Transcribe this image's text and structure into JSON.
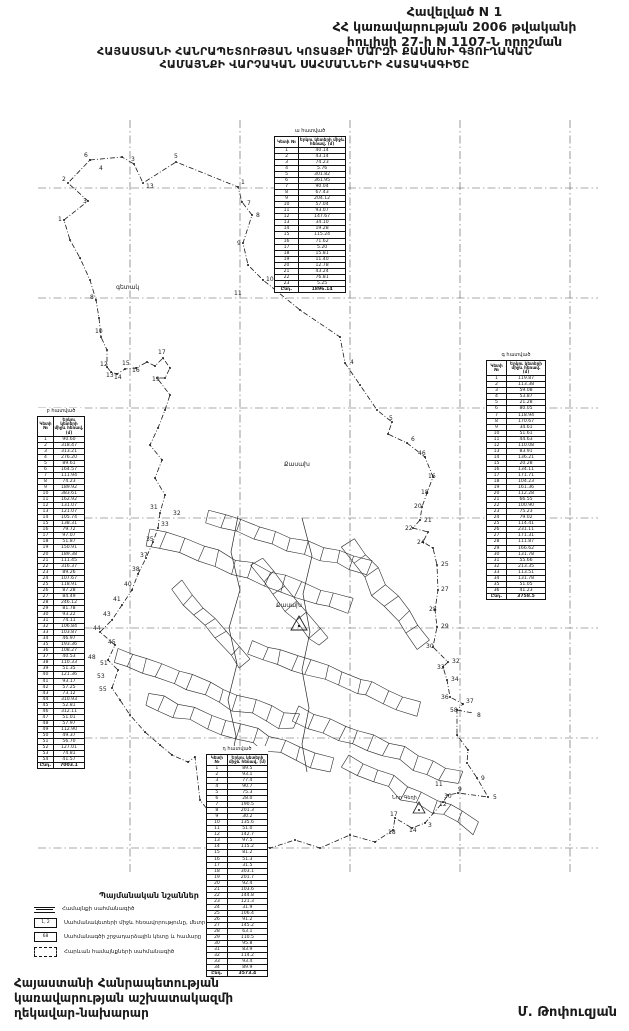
{
  "header": {
    "line1": "Հավելված N 1",
    "line2": "ՀՀ կառավարության 2006 թվականի",
    "line3": "հուլիսի 27-ի N 1107-Ն որոշման"
  },
  "title": {
    "line1": "ՀԱՅԱՍՏԱՆԻ ՀԱՆՐԱՊԵՏՈՒԹՅԱՆ ԿՈՏԱՅՔԻ ՄԱՐԶԻ ՔԱՍԱԽԻ ԳՅՈՒՂԱԿԱՆ",
    "line2": "ՀԱՄԱՅՆՔԻ ՎԱՐՉԱԿԱՆ ՍԱՀՄԱՆՆԵՐԻ ՀԱՏԱԿԱԳԻԾԸ"
  },
  "tables": {
    "top": {
      "caption": "ա հատված",
      "col_point": "Կետի №",
      "col_dist": "Երկու կետերի միջև հեռավ. (մ)",
      "rows": [
        [
          "1",
          "40.14"
        ],
        [
          "2",
          "43.14"
        ],
        [
          "3",
          "74.23"
        ],
        [
          "4",
          "5.76"
        ],
        [
          "5",
          "301.82"
        ],
        [
          "6",
          "361.95"
        ],
        [
          "7",
          "90.04"
        ],
        [
          "8",
          "67.43"
        ],
        [
          "9",
          "204.12"
        ],
        [
          "10",
          "57.04"
        ],
        [
          "11",
          "93.07"
        ],
        [
          "12",
          "147.67"
        ],
        [
          "13",
          "34.10"
        ],
        [
          "14",
          "19.28"
        ],
        [
          "15",
          "115.24"
        ],
        [
          "16",
          "71.62"
        ],
        [
          "17",
          "5.20"
        ],
        [
          "18",
          "15.81"
        ],
        [
          "19",
          "11.40"
        ],
        [
          "20",
          "12.78"
        ],
        [
          "21",
          "43.24"
        ],
        [
          "22",
          "76.81"
        ],
        [
          "23",
          "5.25"
        ]
      ],
      "total_label": "Ընդ.",
      "total_value": "1896.14"
    },
    "left": {
      "caption": "բ հատված",
      "col_point": "Կետի №",
      "col_dist": "Երկու կետերի միջև հեռավ. (մ)",
      "rows": [
        [
          "1",
          "90.60"
        ],
        [
          "2",
          "318.47"
        ],
        [
          "3",
          "313.21"
        ],
        [
          "4",
          "276.20"
        ],
        [
          "5",
          "89.61"
        ],
        [
          "6",
          "164.57"
        ],
        [
          "7",
          "111.94"
        ],
        [
          "8",
          "74.23"
        ],
        [
          "9",
          "189.92"
        ],
        [
          "10",
          "383.61"
        ],
        [
          "11",
          "162.92"
        ],
        [
          "12",
          "131.07"
        ],
        [
          "13",
          "121.07"
        ],
        [
          "14",
          "105.74"
        ],
        [
          "15",
          "138.31"
        ],
        [
          "16",
          "79.72"
        ],
        [
          "17",
          "97.07"
        ],
        [
          "18",
          "51.87"
        ],
        [
          "19",
          "150.91"
        ],
        [
          "20",
          "189.38"
        ],
        [
          "21",
          "111.45"
        ],
        [
          "22",
          "316.37"
        ],
        [
          "23",
          "89.26"
        ],
        [
          "24",
          "107.67"
        ],
        [
          "25",
          "118.91"
        ],
        [
          "26",
          "87.28"
        ],
        [
          "27",
          "84.49"
        ],
        [
          "28",
          "246.12"
        ],
        [
          "29",
          "81.78"
        ],
        [
          "30",
          "93.22"
        ],
        [
          "31",
          "74.11"
        ],
        [
          "32",
          "106.84"
        ],
        [
          "33",
          "103.87"
        ],
        [
          "34",
          "46.97"
        ],
        [
          "35",
          "193.36"
        ],
        [
          "36",
          "108.27"
        ],
        [
          "37",
          "40.53"
        ],
        [
          "38",
          "110.33"
        ],
        [
          "39",
          "51.35"
        ],
        [
          "40",
          "121.36"
        ],
        [
          "41",
          "93.17"
        ],
        [
          "42",
          "57.25"
        ],
        [
          "43",
          "73.12"
        ],
        [
          "44",
          "310.93"
        ],
        [
          "45",
          "52.81"
        ],
        [
          "46",
          "312.11"
        ],
        [
          "47",
          "51.01"
        ],
        [
          "48",
          "57.97"
        ],
        [
          "49",
          "112.90"
        ],
        [
          "50",
          "49.37"
        ],
        [
          "51",
          "56.70"
        ],
        [
          "52",
          "127.01"
        ],
        [
          "53",
          "74.81"
        ],
        [
          "54",
          "41.57"
        ]
      ],
      "total_label": "Ընդ.",
      "total_value": "7003.1"
    },
    "right": {
      "caption": "գ հատված",
      "col_point": "Կետի №",
      "col_dist": "Երկու կետերի միջև հեռավ. (մ)",
      "rows": [
        [
          "1",
          "119.87"
        ],
        [
          "2",
          "113.38"
        ],
        [
          "3",
          "59.08"
        ],
        [
          "4",
          "53.87"
        ],
        [
          "5",
          "21.28"
        ],
        [
          "6",
          "80.05"
        ],
        [
          "7",
          "118.94"
        ],
        [
          "8",
          "170.67"
        ],
        [
          "9",
          "34.61"
        ],
        [
          "10",
          "51.61"
        ],
        [
          "11",
          "44.63"
        ],
        [
          "12",
          "110.08"
        ],
        [
          "13",
          "83.91"
        ],
        [
          "14",
          "136.21"
        ],
        [
          "15",
          "20.28"
        ],
        [
          "16",
          "134.11"
        ],
        [
          "17",
          "171.71"
        ],
        [
          "18",
          "104.23"
        ],
        [
          "19",
          "161.36"
        ],
        [
          "20",
          "112.28"
        ],
        [
          "21",
          "66.55"
        ],
        [
          "22",
          "100.90"
        ],
        [
          "23",
          "75.23"
        ],
        [
          "24",
          "79.02"
        ],
        [
          "25",
          "114.41"
        ],
        [
          "26",
          "231.11"
        ],
        [
          "27",
          "171.31"
        ],
        [
          "28",
          "111.87"
        ],
        [
          "29",
          "166.62"
        ],
        [
          "30",
          "131.78"
        ],
        [
          "31",
          "55.66"
        ],
        [
          "32",
          "213.35"
        ],
        [
          "33",
          "113.51"
        ],
        [
          "34",
          "131.78"
        ],
        [
          "35",
          "51.05"
        ],
        [
          "36",
          "41.23"
        ]
      ],
      "total_label": "Ընդ.",
      "total_value": "3758.5"
    },
    "bottom": {
      "caption": "դ հատված",
      "col_point": "Կետի №",
      "col_dist": "Երկու կետերի միջև հեռավ. (մ)",
      "rows": [
        [
          "1",
          "89.5"
        ],
        [
          "2",
          "93.1"
        ],
        [
          "3",
          "77.4"
        ],
        [
          "4",
          "90.7"
        ],
        [
          "5",
          "75.3"
        ],
        [
          "6",
          "28.0"
        ],
        [
          "7",
          "190.5"
        ],
        [
          "8",
          "201.3"
        ],
        [
          "9",
          "30.2"
        ],
        [
          "10",
          "135.6"
        ],
        [
          "11",
          "51.0"
        ],
        [
          "12",
          "142.7"
        ],
        [
          "13",
          "97.5"
        ],
        [
          "14",
          "115.2"
        ],
        [
          "15",
          "81.2"
        ],
        [
          "16",
          "51.3"
        ],
        [
          "17",
          "31.5"
        ],
        [
          "18",
          "303.1"
        ],
        [
          "19",
          "201.7"
        ],
        [
          "20",
          "92.4"
        ],
        [
          "21",
          "103.6"
        ],
        [
          "22",
          "144.8"
        ],
        [
          "23",
          "121.3"
        ],
        [
          "24",
          "31.9"
        ],
        [
          "25",
          "106.4"
        ],
        [
          "26",
          "91.2"
        ],
        [
          "27",
          "145.2"
        ],
        [
          "28",
          "63.1"
        ],
        [
          "29",
          "110.5"
        ],
        [
          "30",
          "95.8"
        ],
        [
          "31",
          "83.9"
        ],
        [
          "32",
          "114.2"
        ],
        [
          "33",
          "93.4"
        ],
        [
          "34",
          "89.9"
        ]
      ],
      "total_label": "Ընդ.",
      "total_value": "3573.4"
    }
  },
  "legend": {
    "title": "Պայմանական նշաններ",
    "symbol2_text": "1, 2",
    "symbol3_text": "68",
    "items": [
      {
        "label": "Համայնքի սահմանագիծ"
      },
      {
        "label": "Սահմանակետերի միջև հեռավորությունը, մետր"
      },
      {
        "label": "Սահմանագծի շրջադարձային կետը և համարը"
      },
      {
        "label": "Հարևան համայնքների սահմանագիծ"
      }
    ]
  },
  "footer": {
    "left_line1": "Հայաստանի Հանրապետության",
    "left_line2": "կառավարության աշխատակազմի",
    "left_line3": "ղեկավար-նախարար",
    "signature": "Մ. Թոփուզյան"
  },
  "map": {
    "place_labels": [
      {
        "t": "գետակ",
        "x": 116,
        "y": 289,
        "s": 6
      },
      {
        "t": "Քասախ",
        "x": 284,
        "y": 466,
        "s": 6
      },
      {
        "t": "Քասախ",
        "x": 276,
        "y": 607,
        "s": 6
      },
      {
        "t": "Նոր Գեղի",
        "x": 392,
        "y": 799,
        "s": 5
      }
    ],
    "point_labels": [
      {
        "t": "6",
        "x": 84,
        "y": 157
      },
      {
        "t": "4",
        "x": 99,
        "y": 170
      },
      {
        "t": "3",
        "x": 131,
        "y": 161
      },
      {
        "t": "13",
        "x": 146,
        "y": 188
      },
      {
        "t": "5",
        "x": 174,
        "y": 158
      },
      {
        "t": "1",
        "x": 241,
        "y": 184
      },
      {
        "t": "7",
        "x": 247,
        "y": 205
      },
      {
        "t": "8",
        "x": 256,
        "y": 217
      },
      {
        "t": "9",
        "x": 237,
        "y": 245
      },
      {
        "t": "10",
        "x": 266,
        "y": 281
      },
      {
        "t": "11",
        "x": 234,
        "y": 295
      },
      {
        "t": "2",
        "x": 62,
        "y": 181
      },
      {
        "t": "3",
        "x": 83,
        "y": 203
      },
      {
        "t": "1",
        "x": 58,
        "y": 221
      },
      {
        "t": "8",
        "x": 90,
        "y": 299
      },
      {
        "t": "10",
        "x": 95,
        "y": 333
      },
      {
        "t": "12",
        "x": 100,
        "y": 366
      },
      {
        "t": "13",
        "x": 106,
        "y": 377
      },
      {
        "t": "14",
        "x": 114,
        "y": 379
      },
      {
        "t": "15",
        "x": 122,
        "y": 365
      },
      {
        "t": "16",
        "x": 132,
        "y": 372
      },
      {
        "t": "17",
        "x": 158,
        "y": 354
      },
      {
        "t": "19",
        "x": 152,
        "y": 381
      },
      {
        "t": "4",
        "x": 350,
        "y": 364
      },
      {
        "t": "5",
        "x": 389,
        "y": 420
      },
      {
        "t": "6",
        "x": 411,
        "y": 441
      },
      {
        "t": "46",
        "x": 418,
        "y": 455
      },
      {
        "t": "16",
        "x": 428,
        "y": 478
      },
      {
        "t": "18",
        "x": 421,
        "y": 494
      },
      {
        "t": "20",
        "x": 414,
        "y": 508
      },
      {
        "t": "21",
        "x": 424,
        "y": 522
      },
      {
        "t": "22",
        "x": 405,
        "y": 530
      },
      {
        "t": "24",
        "x": 417,
        "y": 544
      },
      {
        "t": "25",
        "x": 441,
        "y": 566
      },
      {
        "t": "27",
        "x": 441,
        "y": 591
      },
      {
        "t": "28",
        "x": 429,
        "y": 611
      },
      {
        "t": "29",
        "x": 441,
        "y": 628
      },
      {
        "t": "30",
        "x": 426,
        "y": 648
      },
      {
        "t": "32",
        "x": 452,
        "y": 663
      },
      {
        "t": "33",
        "x": 437,
        "y": 669
      },
      {
        "t": "34",
        "x": 451,
        "y": 681
      },
      {
        "t": "36",
        "x": 441,
        "y": 699
      },
      {
        "t": "37",
        "x": 466,
        "y": 703
      },
      {
        "t": "58",
        "x": 450,
        "y": 712
      },
      {
        "t": "8",
        "x": 477,
        "y": 717
      },
      {
        "t": "9",
        "x": 481,
        "y": 780
      },
      {
        "t": "5",
        "x": 493,
        "y": 799
      },
      {
        "t": "11",
        "x": 435,
        "y": 786
      },
      {
        "t": "30",
        "x": 444,
        "y": 798
      },
      {
        "t": "9",
        "x": 458,
        "y": 791
      },
      {
        "t": "12",
        "x": 439,
        "y": 806
      },
      {
        "t": "3",
        "x": 428,
        "y": 827
      },
      {
        "t": "14",
        "x": 409,
        "y": 832
      },
      {
        "t": "17",
        "x": 390,
        "y": 816
      },
      {
        "t": "18",
        "x": 388,
        "y": 834
      },
      {
        "t": "31",
        "x": 150,
        "y": 509
      },
      {
        "t": "32",
        "x": 173,
        "y": 515
      },
      {
        "t": "33",
        "x": 161,
        "y": 526
      },
      {
        "t": "35",
        "x": 146,
        "y": 541
      },
      {
        "t": "37",
        "x": 140,
        "y": 557
      },
      {
        "t": "38",
        "x": 132,
        "y": 571
      },
      {
        "t": "40",
        "x": 124,
        "y": 586
      },
      {
        "t": "41",
        "x": 113,
        "y": 601
      },
      {
        "t": "43",
        "x": 103,
        "y": 616
      },
      {
        "t": "44",
        "x": 93,
        "y": 630
      },
      {
        "t": "45",
        "x": 108,
        "y": 644
      },
      {
        "t": "48",
        "x": 88,
        "y": 659
      },
      {
        "t": "51",
        "x": 100,
        "y": 665
      },
      {
        "t": "53",
        "x": 97,
        "y": 678
      },
      {
        "t": "55",
        "x": 99,
        "y": 691
      },
      {
        "t": "45",
        "x": 252,
        "y": 757
      },
      {
        "t": "46",
        "x": 256,
        "y": 770
      },
      {
        "t": "41",
        "x": 258,
        "y": 779
      },
      {
        "t": "42",
        "x": 252,
        "y": 788
      }
    ]
  }
}
